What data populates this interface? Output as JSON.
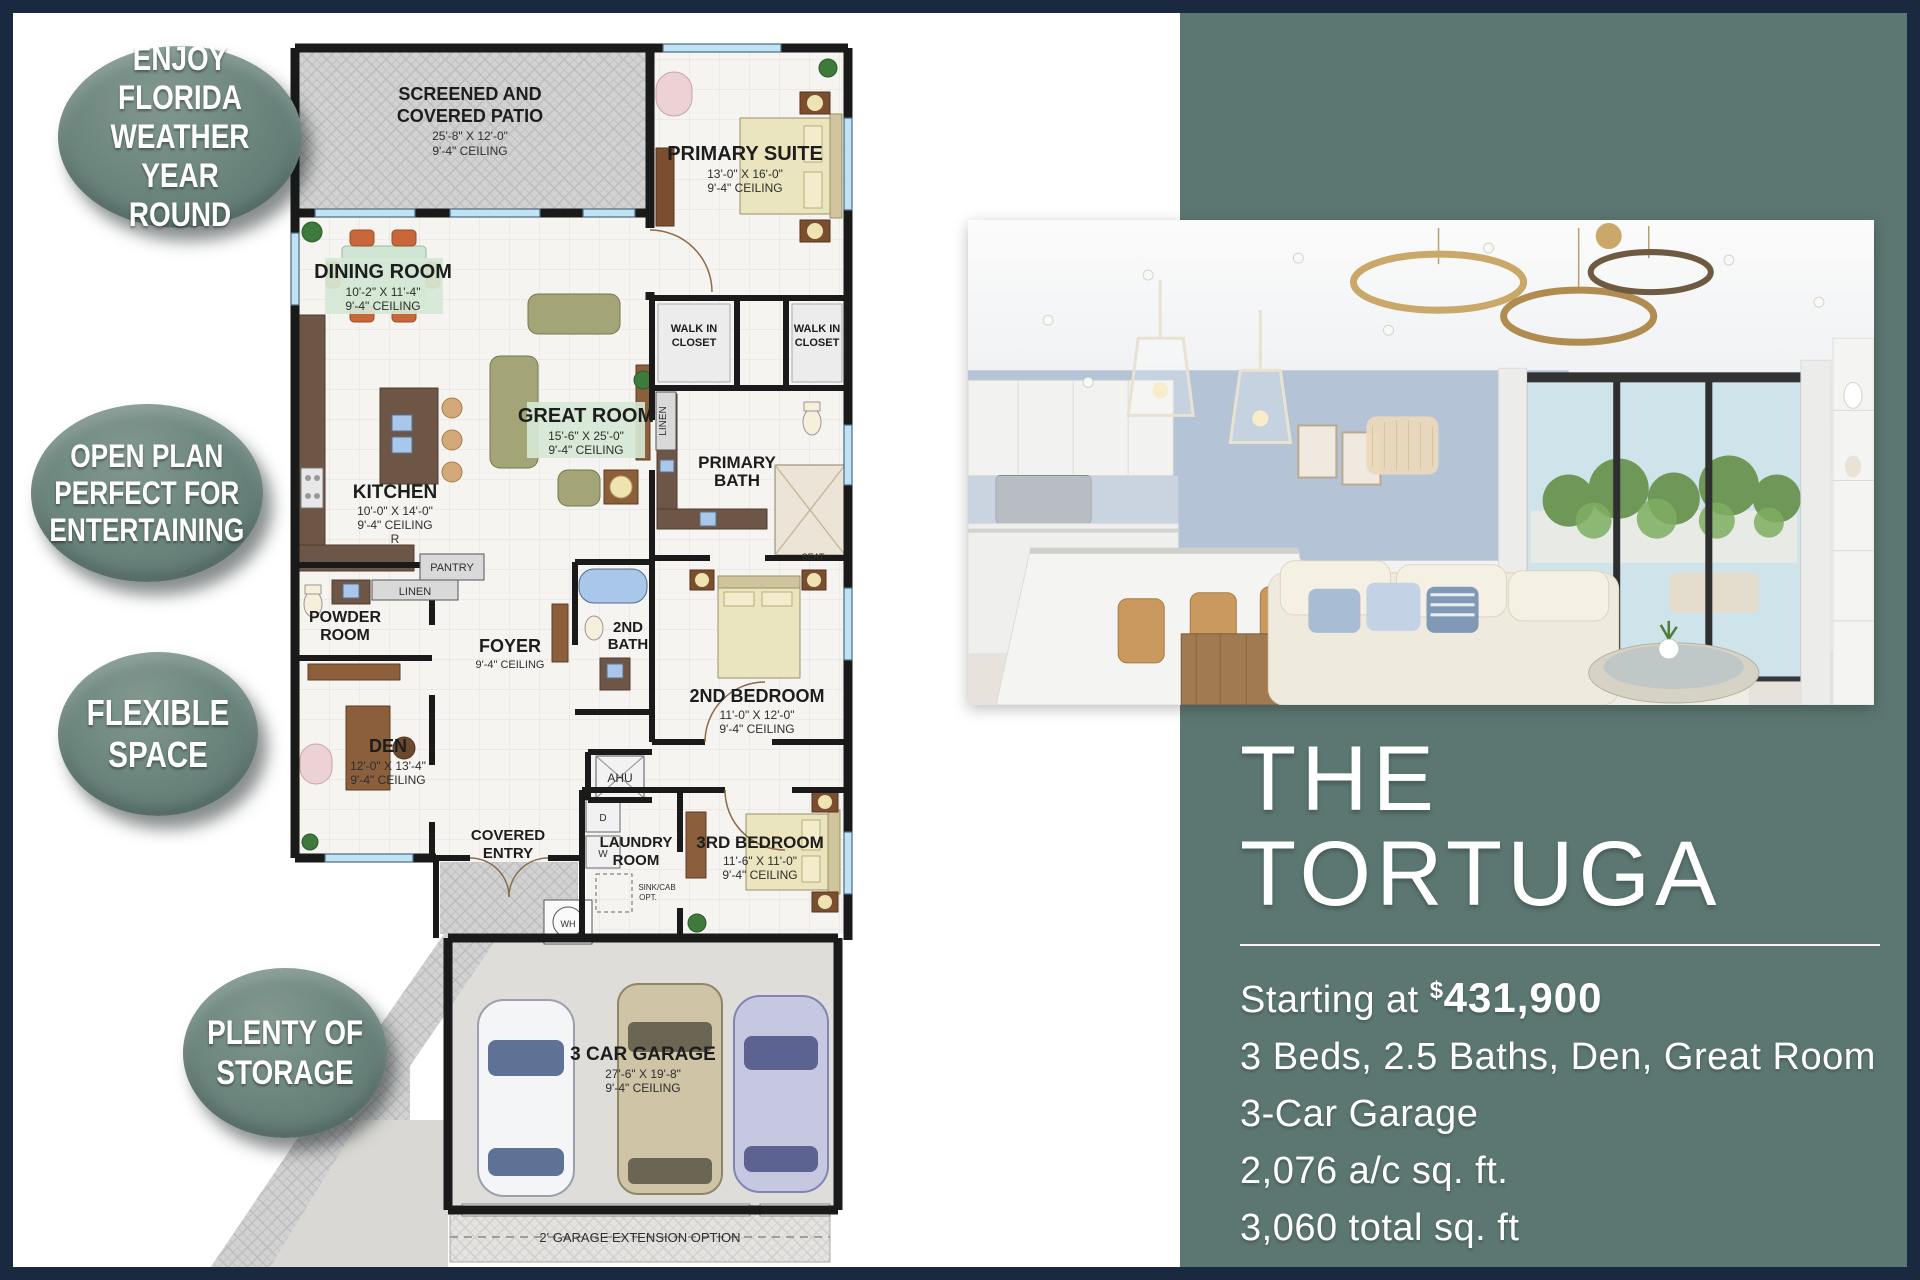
{
  "page": {
    "border_color": "#1a2940",
    "background": "#ffffff",
    "panel_color": "#5c7772"
  },
  "badges": [
    {
      "lines": [
        "ENJOY FLORIDA",
        "WEATHER YEAR",
        "ROUND"
      ]
    },
    {
      "lines": [
        "OPEN PLAN",
        "PERFECT FOR",
        "ENTERTAINING"
      ]
    },
    {
      "lines": [
        "FLEXIBLE",
        "SPACE"
      ]
    },
    {
      "lines": [
        "PLENTY OF",
        "STORAGE"
      ]
    }
  ],
  "panel": {
    "title_line1": "THE",
    "title_line2": "TORTUGA",
    "price": {
      "prefix": "Starting at ",
      "currency": "$",
      "amount": "431,900"
    },
    "specs": [
      "3 Beds, 2.5 Baths, Den, Great Room",
      "3-Car Garage",
      "2,076 a/c sq. ft.",
      "3,060 total sq. ft"
    ]
  },
  "floorplan": {
    "rooms": {
      "patio": {
        "l1": "SCREENED AND",
        "l2": "COVERED PATIO",
        "dims": "25'-8\" X 12'-0\"",
        "ceil": "9'-4\" CEILING"
      },
      "suite": {
        "l1": "PRIMARY SUITE",
        "dims": "13'-0\" X 16'-0\"",
        "ceil": "9'-4\" CEILING"
      },
      "dining": {
        "l1": "DINING ROOM",
        "dims": "10'-2\" X 11'-4\"",
        "ceil": "9'-4\" CEILING"
      },
      "great": {
        "l1": "GREAT ROOM",
        "dims": "15'-6\" X 25'-0\"",
        "ceil": "9'-4\" CEILING"
      },
      "kitchen": {
        "l1": "KITCHEN",
        "dims": "10'-0\" X 14'-0\"",
        "ceil": "9'-4\" CEILING",
        "extra": "R"
      },
      "wic1": {
        "l1": "WALK IN",
        "l2": "CLOSET"
      },
      "wic2": {
        "l1": "WALK IN",
        "l2": "CLOSET"
      },
      "pbath": {
        "l1": "PRIMARY",
        "l2": "BATH"
      },
      "powder": {
        "l1": "POWDER",
        "l2": "ROOM"
      },
      "foyer": {
        "l1": "FOYER",
        "ceil": "9'-4\" CEILING"
      },
      "bath2": {
        "l1": "2ND",
        "l2": "BATH"
      },
      "bed2": {
        "l1": "2ND BEDROOM",
        "dims": "11'-0\" X 12'-0\"",
        "ceil": "9'-4\" CEILING"
      },
      "den": {
        "l1": "DEN",
        "dims": "12'-0\" X 13'-4\"",
        "ceil": "9'-4\" CEILING"
      },
      "entry": {
        "l1": "COVERED",
        "l2": "ENTRY"
      },
      "laundry": {
        "l1": "LAUNDRY",
        "l2": "ROOM"
      },
      "bed3": {
        "l1": "3RD BEDROOM",
        "dims": "11'-6\" X 11'-0\"",
        "ceil": "9'-4\" CEILING"
      },
      "garage": {
        "l1": "3 CAR GARAGE",
        "dims": "27'-6\" X 19'-8\"",
        "ceil": "9'-4\" CEILING"
      }
    },
    "labels": {
      "pantry": "PANTRY",
      "linen": "LINEN",
      "linen2": "LINEN",
      "seat": "SEAT",
      "ahu": "AHU",
      "wh": "WH",
      "dryer": "D",
      "washer": "W",
      "sink_opt1": "SINK/CAB",
      "sink_opt2": "OPT.",
      "extension": "2' GARAGE EXTENSION OPTION"
    }
  }
}
